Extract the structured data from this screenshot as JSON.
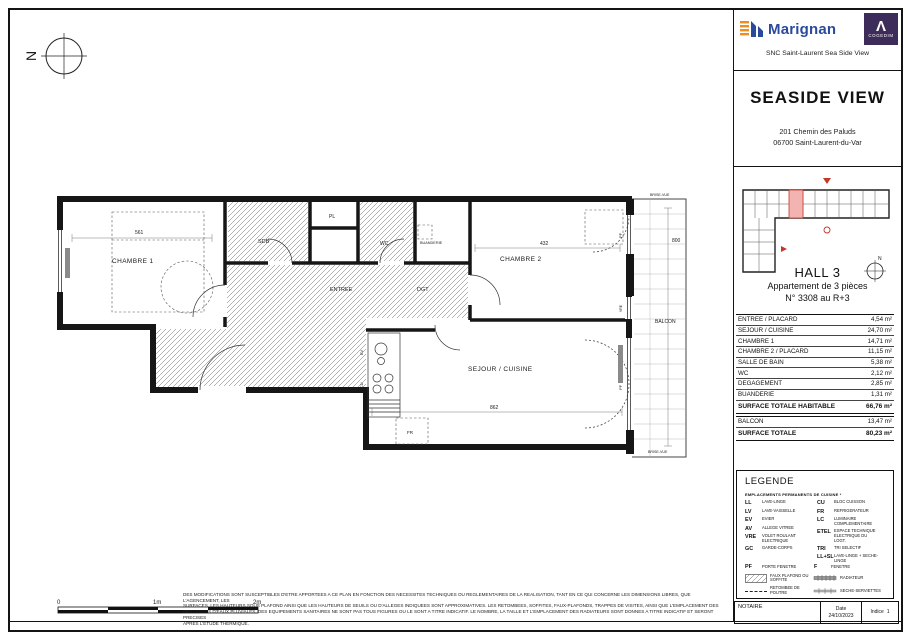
{
  "header": {
    "brand_marignan": "Marignan",
    "brand_cogedim_glyph": "Λ",
    "brand_cogedim": "COGEDIM",
    "snc_line": "SNC Saint-Laurent Sea Side View",
    "project_title": "SEASIDE VIEW",
    "address_line1": "201 Chemin des Paluds",
    "address_line2": "06700 Saint-Laurent-du-Var"
  },
  "unit": {
    "hall": "HALL 3",
    "type": "Appartement de 3 pièces",
    "number": "N° 3308 au R+3"
  },
  "areas": {
    "rows": [
      {
        "label": "ENTREE / PLACARD",
        "value": "4,54 m²"
      },
      {
        "label": "SEJOUR / CUISINE",
        "value": "24,70 m²"
      },
      {
        "label": "CHAMBRE 1",
        "value": "14,71 m²"
      },
      {
        "label": "CHAMBRE 2 / PLACARD",
        "value": "11,15 m²"
      },
      {
        "label": "SALLE DE BAIN",
        "value": "5,38 m²"
      },
      {
        "label": "WC",
        "value": "2,12 m²"
      },
      {
        "label": "DEGAGEMENT",
        "value": "2,85 m²"
      },
      {
        "label": "BUANDERIE",
        "value": "1,31 m²"
      }
    ],
    "total_habitable": {
      "label": "SURFACE TOTALE HABITABLE",
      "value": "66,76 m²"
    },
    "balcon": {
      "label": "BALCON",
      "value": "13,47 m²"
    },
    "total": {
      "label": "SURFACE TOTALE",
      "value": "80,23 m²"
    }
  },
  "legend": {
    "title": "LEGENDE",
    "note": "EMPLACEMENTS PERMANENTS DE CUISINE *",
    "left": [
      {
        "abbr": "LL",
        "label": "LAVE-LINGE"
      },
      {
        "abbr": "LV",
        "label": "LAVE-VAISSELLE"
      },
      {
        "abbr": "EV",
        "label": "EVIER"
      },
      {
        "abbr": "AV",
        "label": "ALLEGE VITREE"
      },
      {
        "abbr": "VRE",
        "label": "VOLET ROULANT ELECTRIQUE"
      },
      {
        "abbr": "GC",
        "label": "GARDE-CORPS"
      }
    ],
    "right": [
      {
        "abbr": "CU",
        "label": "BLOC CUISSON"
      },
      {
        "abbr": "FR",
        "label": "REFRIGERATEUR"
      },
      {
        "abbr": "LC",
        "label": "LUMINAIRE COMPLEMENTAIRE"
      },
      {
        "abbr": "ETEL",
        "label": "ESPACE TECHNIQUE ELECTRIQUE DU LOGT."
      },
      {
        "abbr": "TRI",
        "label": "TRI SELECTIF"
      },
      {
        "abbr": "LL+SL",
        "label": "LAVE-LINGE + SECHE-LINGE"
      }
    ],
    "pf": {
      "abbr": "PF",
      "label": "PORTE FENETRE"
    },
    "f": {
      "abbr": "F",
      "label": "FENETRE"
    },
    "faux_plafond": "FAUX PLAFOND OU SOFFITE",
    "radiateur": "RADIATEUR",
    "retombee": "RETOMBEE DE POUTRE",
    "seche": "SECHE-SERVIETTES"
  },
  "plan": {
    "compass": "N",
    "rooms": {
      "chambre1": "CHAMBRE 1",
      "chambre2": "CHAMBRE 2",
      "sdb": "SDB",
      "pl": "PL",
      "wc": "WC",
      "buanderie": "BUANDERIE",
      "entree": "ENTREE",
      "dgt": "DGT",
      "sejour": "SEJOUR / CUISINE",
      "balcon": "BALCON"
    },
    "fixtures": {
      "fr": "FR",
      "ev": "EV",
      "cu": "CU"
    },
    "openings": {
      "pf": "PF",
      "vre": "VRE"
    },
    "brise_vue": "BRISE-VUE",
    "dims": {
      "d561": "561",
      "d432": "432",
      "d862": "862",
      "d800": "800"
    }
  },
  "scalebar": {
    "t0": "0",
    "t1": "1m",
    "t2": "2m"
  },
  "disclaimer": {
    "lines": [
      "DES MODIFICATIONS SONT SUSCEPTIBLES D'ETRE APPORTEES A CE PLAN EN FONCTION DES NECESSITES TECHNIQUES OU REGLEMENTAIRES DE LA REALISATION, TANT EN CE QUI CONCERNE LES DIMENSIONS LIBRES, QUE L'AGENCEMENT, LES",
      "SURFACES. LES HAUTEURS SOUS PLAFOND AINSI QUE LES HAUTEURS DE SEUILS OU D'ALLEGES INDIQUEES SONT APPROXIMATIVES. LES RETOMBEES, SOFFITES, FAUX-PLAFONDS, TRAPPES DE VISITES, AINSI QUE L'EMPLACEMENT DES",
      "DESCENTES D'EAUX PLUVIALES, DES EQUIPEMENTS SANITAIRES NE SONT PAS TOUS FIGURES OU LE SONT A TITRE INDICATIF. LE NOMBRE, LA TAILLE ET L'EMPLACEMENT DES RADIATEURS SONT DONNES A TITRE INDICATIF ET SERONT PRECISES",
      "APRES L'ETUDE THERMIQUE."
    ]
  },
  "footer": {
    "notaire": "NOTAIRE",
    "date_label": "Date",
    "date_value": "24/10/2023",
    "indice_label": "Indice",
    "indice_value": "1"
  }
}
